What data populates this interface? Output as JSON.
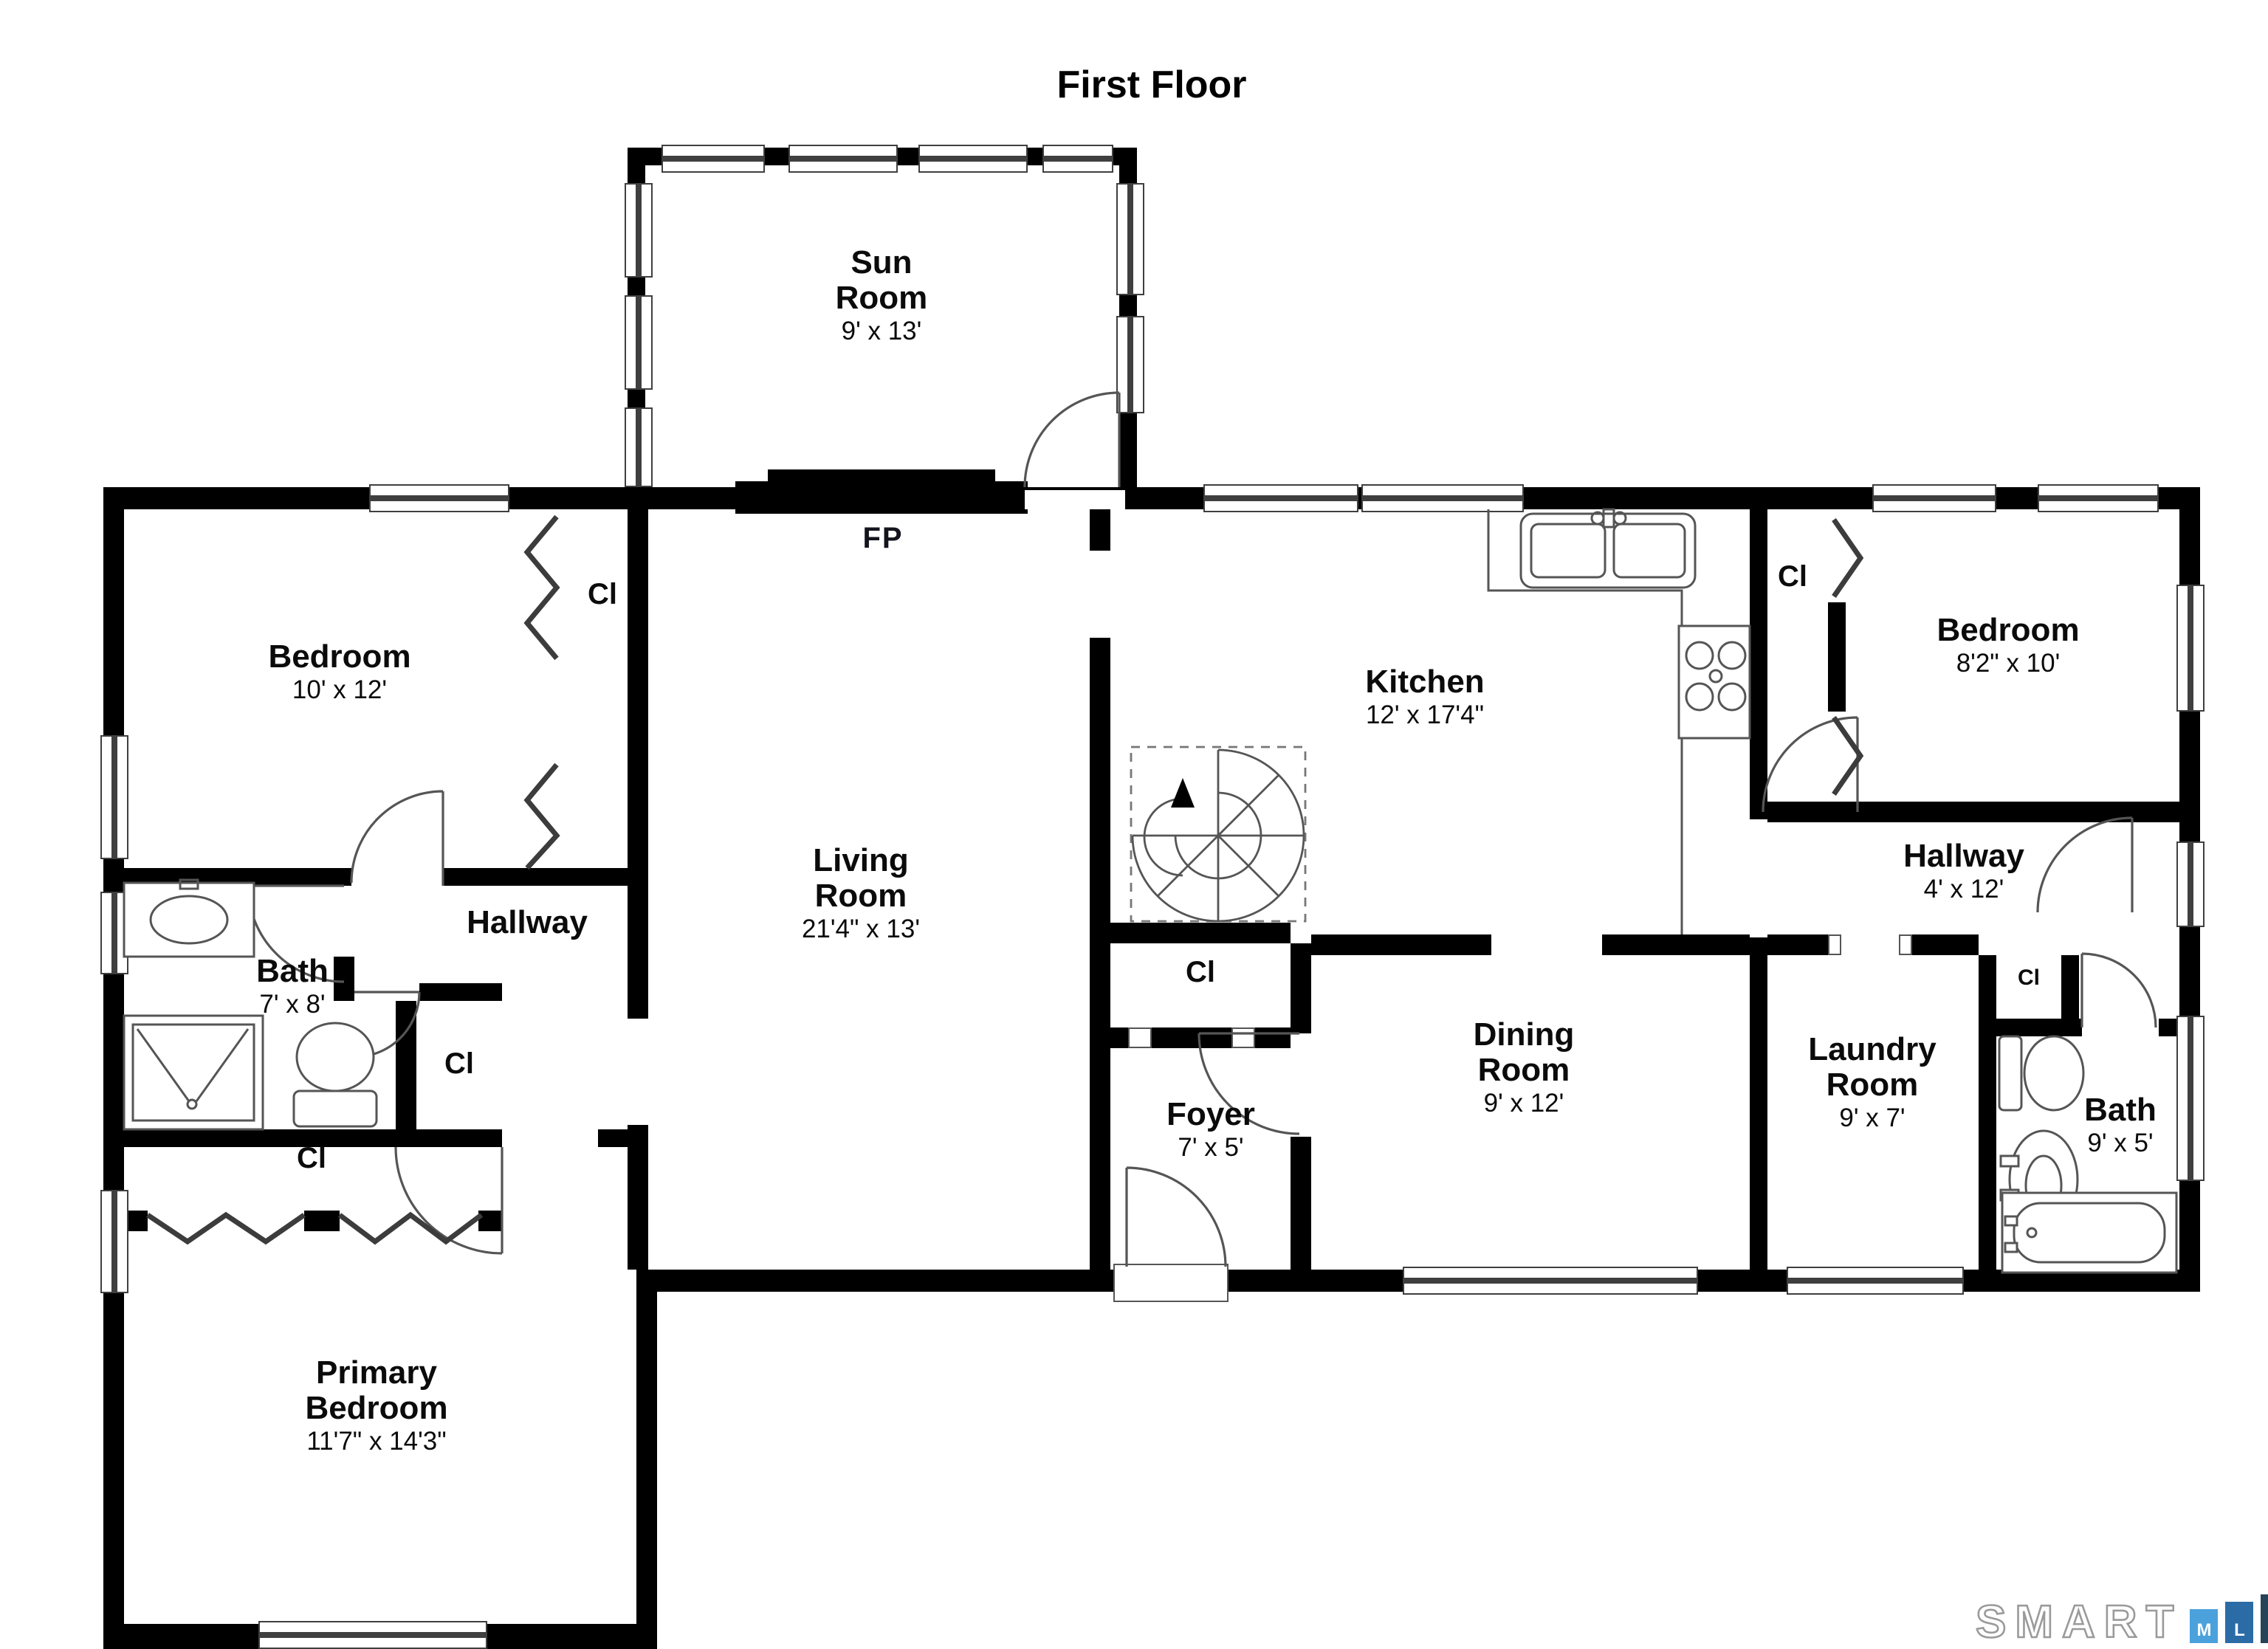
{
  "title": "First Floor",
  "rooms": {
    "sun_room": {
      "name": "Sun Room",
      "dims": "9' x 13'"
    },
    "bedroom_left": {
      "name": "Bedroom",
      "dims": "10' x 12'"
    },
    "living_room": {
      "name": "Living Room",
      "dims": "21'4\" x 13'"
    },
    "kitchen": {
      "name": "Kitchen",
      "dims": "12' x 17'4\""
    },
    "bedroom_right": {
      "name": "Bedroom",
      "dims": "8'2\" x 10'"
    },
    "hallway_right": {
      "name": "Hallway",
      "dims": "4' x 12'"
    },
    "hallway_left": {
      "name": "Hallway"
    },
    "bath_left": {
      "name": "Bath",
      "dims": "7' x 8'"
    },
    "dining_room": {
      "name": "Dining Room",
      "dims": "9' x 12'"
    },
    "foyer": {
      "name": "Foyer",
      "dims": "7' x 5'"
    },
    "laundry_room": {
      "name": "Laundry Room",
      "dims": "9' x 7'"
    },
    "bath_right": {
      "name": "Bath",
      "dims": "9' x 5'"
    },
    "primary_bedroom": {
      "name": "Primary Bedroom",
      "dims": "11'7\" x 14'3\""
    }
  },
  "markers": {
    "closet": "Cl",
    "fireplace": "FP"
  },
  "logo": {
    "word": "SMART",
    "letters": [
      "M",
      "L",
      "S"
    ],
    "letter_colors": [
      "#4ba1dc",
      "#2b6ca7",
      "#264358"
    ]
  }
}
